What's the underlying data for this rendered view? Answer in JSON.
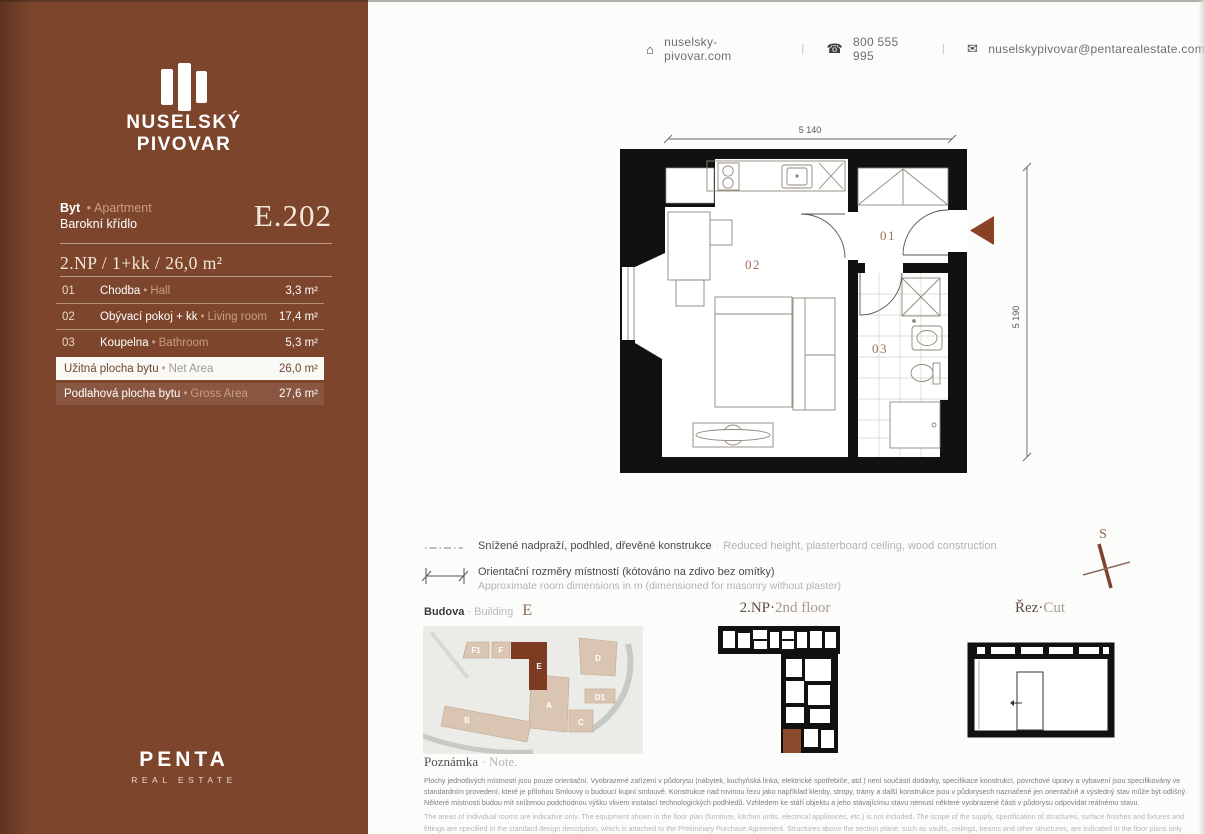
{
  "theme": {
    "sidebar_bg": "#7c452c",
    "accent_arrow": "#8a4226",
    "cream": "#f2e7d8",
    "tan": "#c79d83",
    "wall": "#111111"
  },
  "ui": {
    "bullet": "•",
    "divider": "|",
    "dot": "·"
  },
  "sidebar": {
    "brand": {
      "line1": "NUSELSKÝ",
      "line2": "PIVOVAR"
    },
    "unit": {
      "type_cz": "Byt",
      "type_en": "Apartment",
      "wing": "Barokní křídlo",
      "code": "E.202"
    },
    "summary": "2.NP / 1+kk / 26,0 m²",
    "rooms": [
      {
        "num": "01",
        "cz": "Chodba",
        "en": "Hall",
        "area": "3,3 m²"
      },
      {
        "num": "02",
        "cz": "Obývací pokoj + kk",
        "en": "Living room",
        "area": "17,4 m²"
      },
      {
        "num": "03",
        "cz": "Koupelna",
        "en": "Bathroom",
        "area": "5,3 m²"
      }
    ],
    "net": {
      "cz": "Užitná plocha bytu",
      "en": "Net Area",
      "value": "26,0 m²"
    },
    "gross": {
      "cz": "Podlahová plocha bytu",
      "en": "Gross Area",
      "value": "27,6 m²"
    },
    "logo": {
      "name": "PENTA",
      "sub": "REAL ESTATE"
    }
  },
  "contact": {
    "home_icon": "⌂",
    "website": "nuselsky-pivovar.com",
    "phone_icon": "☎",
    "phone": "800 555 995",
    "mail_icon": "✉",
    "email": "nuselskypivovar@pentarealestate.com"
  },
  "floorplan": {
    "dim_top": "5 140",
    "dim_right": "5 190",
    "label_01": "01",
    "label_02": "02",
    "label_03": "03",
    "compass": "S"
  },
  "legend": {
    "row1_cz": "Snížené nadpraží, podhled, dřevěné konstrukce",
    "row1_en": "Reduced height, plasterboard ceiling, wood construction",
    "row2_cz": "Orientační rozměry místností (kótováno na zdivo bez omítky)",
    "row2_en": "Approximate room dimensions in m (dimensioned for masonry without plaster)"
  },
  "panels": {
    "building": {
      "cz": "Budova",
      "en": "Building",
      "value": "E",
      "labels": {
        "f1": "F1",
        "f": "F",
        "e": "E",
        "d": "D",
        "d1": "D1",
        "a": "A",
        "c": "C",
        "b": "B"
      }
    },
    "floor": {
      "cz": "2.NP",
      "en": "2nd floor"
    },
    "cut": {
      "cz": "Řez",
      "en": "Cut"
    }
  },
  "note": {
    "title_cz": "Poznámka",
    "title_en": "Note.",
    "cz": "Plochy jednotlivých místností jsou pouze orientační. Vyobrazené zařízení v půdorysu (nábytek, kuchyňská linka, elektrické spotřebiče, atd.) není součástí dodávky, specifikace konstrukcí, povrchové úpravy a vybavení jsou specifikovány ve standardním provedení, které je přílohou Smlouvy o budoucí kupní smlouvě. Konstrukce nad rovinou řezu jako například klenby, stropy, trámy a další konstrukce jsou v půdorysech naznačené jen orientačně a výsledný stav může být odlišný. Některé místnosti budou mít sníženou podchodnou výšku vlivem instalací technologických podhledů. Vzhledem ke stáří objektu a jeho stávajícímu stavu nemusí některé vyobrazené části v půdorysu odpovídat reálnému stavu.",
    "en": "The areas of individual rooms are indicative only. The equipment shown in the floor plan (furniture, kitchen units, electrical appliances, etc.) is not included. The scope of the supply, specification of structures, surface finishes and fixtures and fittings are specified in the standard design description, which is attached to the Preliminary Purchase Agreement. Structures above the section plane, such as vaults, ceilings, beams and other structures, are indicated in the floor plans only as a guide, and the resulting state may be different. Some rooms will have a reduced floor height due to the installation of technological ceilings. Due to the age of the building and its current condition, some parts depicted in the floor plan may not correspond to the real condition."
  }
}
